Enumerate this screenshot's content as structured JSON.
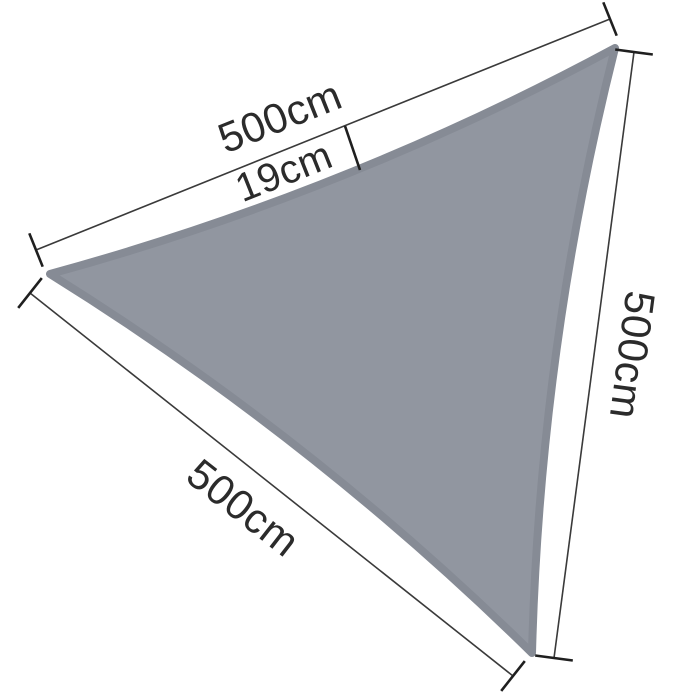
{
  "diagram": {
    "kind": "triangular-shade-sail-dimension-diagram",
    "background": "#ffffff",
    "sail_fill_color": "#9196a0",
    "sail_edge_color": "#868b95",
    "dim_line_color": "#3a3a3a",
    "tick_color": "#1f1f1f",
    "text_color": "#2b2b2b"
  },
  "dimensions": {
    "top": {
      "label": "500cm",
      "value": 500,
      "unit": "cm"
    },
    "sag": {
      "label": "19cm",
      "value": 19,
      "unit": "cm"
    },
    "right": {
      "label": "500cm",
      "value": 500,
      "unit": "cm"
    },
    "bottom_left": {
      "label": "500cm",
      "value": 500,
      "unit": "cm"
    }
  }
}
